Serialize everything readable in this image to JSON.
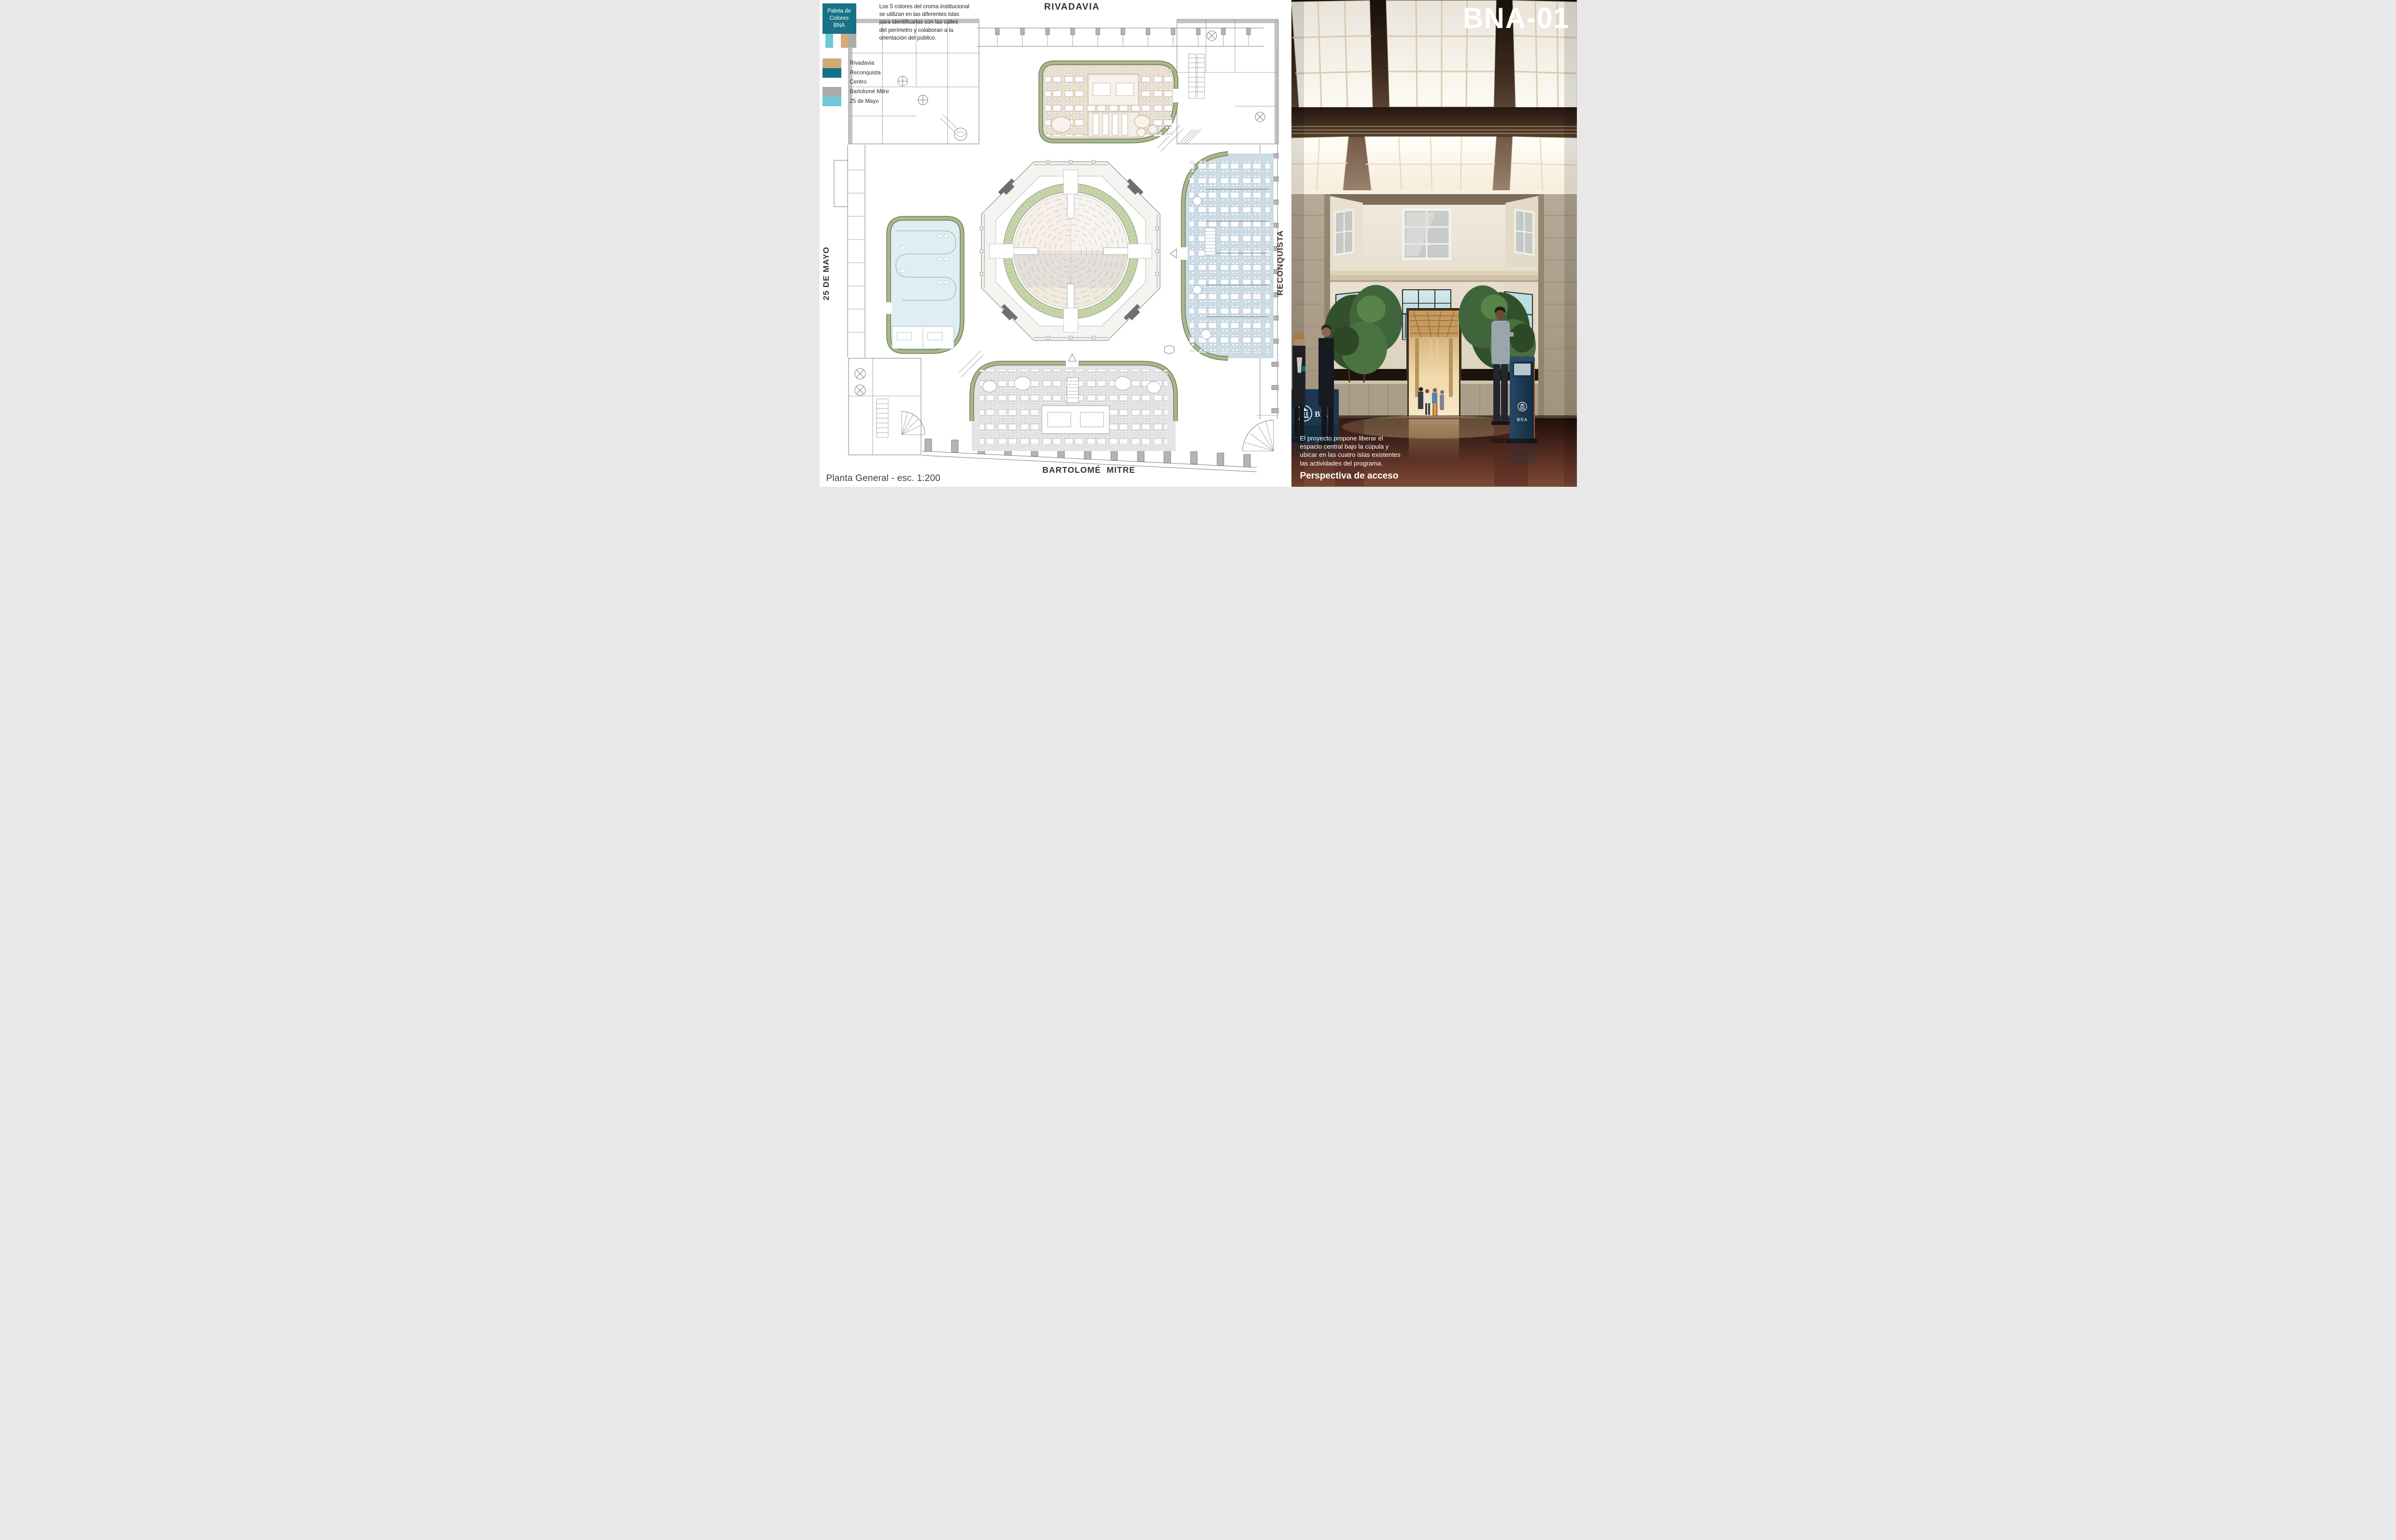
{
  "legend": {
    "box_title_lines": [
      "Paleta de",
      "Colores",
      "BNA"
    ],
    "box_color": "#177286",
    "description_lines": [
      "Los 5 colores del croma institucional",
      "se utilizan en las diferentes islas",
      "para identificarlas con las calles",
      "del perímetro y colaboran a la",
      "orientación del público."
    ],
    "palette": [
      {
        "name": "Rivadavia",
        "hex": "#d4a97c"
      },
      {
        "name": "Reconquista",
        "hex": "#137286"
      },
      {
        "name": "Centro",
        "hex": "#ffffff"
      },
      {
        "name": "Bartolomé Mitre",
        "hex": "#aaabad"
      },
      {
        "name": "25 de Mayo",
        "hex": "#6ec9d4"
      }
    ],
    "chip_colors": [
      "#6ec9d4",
      "#ffffff",
      "#d4a97c",
      "#aaabad"
    ]
  },
  "plan": {
    "caption": "Planta General - esc. 1:200",
    "streets": {
      "top": "RIVADAVIA",
      "right": "RECONQUISTA",
      "bottom": "BARTOLOMÉ  MITRE",
      "left": "25 DE MAYO"
    },
    "island_colors": {
      "rivadavia": "#ebdfce",
      "reconquista": "#ccdce6",
      "bartolome_mitre": "#e4e4e6",
      "veinticinco_de_mayo": "#dfeef2"
    },
    "dome_ring_color": "#c6d4ab"
  },
  "photo": {
    "code": "BNA-01",
    "caption_lines": [
      "El proyecto propone liberar el",
      "espacio central bajo la cúpula y",
      "ubicar en las cuatro islas existentes",
      "las actividades del programa."
    ],
    "caption_heading": "Perspectiva de acceso",
    "banner_text": "BNA",
    "kiosk_text": "BNA"
  }
}
